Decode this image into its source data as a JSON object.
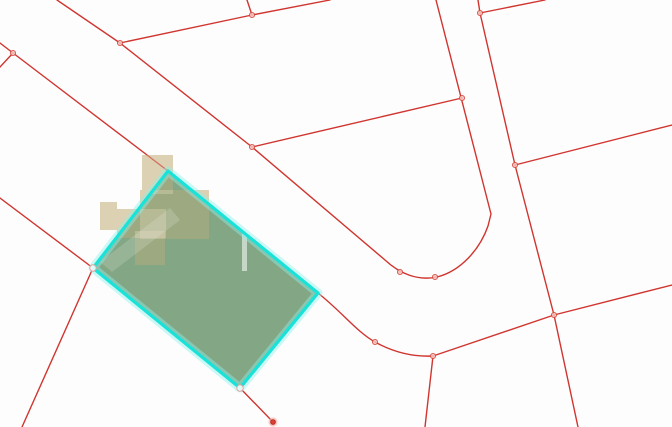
{
  "map": {
    "description": "cadastral-parcel-map-with-selected-parcel",
    "canvas": {
      "width": 672,
      "height": 427,
      "background": "#fdfdfd"
    },
    "colors": {
      "boundary_line": "#ce2a24",
      "vertex_fill": "#f6c0ba",
      "vertex_stroke": "#d4453c",
      "endpoint_fill": "#d94036",
      "endpoint_ring": "#f2b4ae",
      "selection_stroke": "#19e2d8",
      "selection_glow": "#8ef0e9",
      "parcel_fill": "rgba(10,80,12,0.5)",
      "building_fill": "#ddd1b3",
      "building_overlay": "rgba(221,209,179,0.4)",
      "driveway_fill": "rgba(255,255,255,0.55)",
      "path_band_fill": "rgba(255,255,255,0.16)"
    },
    "boundary_paths": [
      {
        "name": "road-northeast-edge-with-corner-fillet",
        "d": "M 57,0 L 120,43 L 252,147 L 385,260 C 400,274 418,281 437,277 C 461,271 480,249 488,226 L 491,214 L 436,0"
      },
      {
        "name": "north-parcel-split-line",
        "d": "M 120,43 L 252,15 L 330,0"
      },
      {
        "name": "north-parcel-stub",
        "d": "M 252,15 L 247,0"
      },
      {
        "name": "west-edge-junction",
        "d": "M 0,43 L 13,53 L 0,67"
      },
      {
        "name": "road-southwest-edge-through-parcel",
        "d": "M 13,53 L 168,171 L 318,293 C 343,313 357,332 375,342 C 393,352 413,357 433,356 L 554,315"
      },
      {
        "name": "south-branch-line",
        "d": "M 433,356 L 425,427"
      },
      {
        "name": "vertical-road-east-edge",
        "d": "M 478,0 L 480,13 L 515,165 L 554,315 L 578,427"
      },
      {
        "name": "northeast-corner-branch",
        "d": "M 480,13 L 545,0"
      },
      {
        "name": "east-parcel-line-upper",
        "d": "M 515,165 L 672,125"
      },
      {
        "name": "east-parcel-line-lower",
        "d": "M 554,315 L 672,285"
      },
      {
        "name": "mid-cross-boundary-line",
        "d": "M 252,147 L 462,98"
      },
      {
        "name": "west-parcel-boundary",
        "d": "M 0,198 L 93,268 L 22,427"
      },
      {
        "name": "selected-parcel-south-stub",
        "d": "M 240,388 L 273,422"
      }
    ],
    "vertices": [
      [
        13,
        53
      ],
      [
        120,
        43
      ],
      [
        252,
        15
      ],
      [
        252,
        147
      ],
      [
        462,
        98
      ],
      [
        480,
        13
      ],
      [
        515,
        165
      ],
      [
        554,
        315
      ],
      [
        375,
        342
      ],
      [
        400,
        272
      ],
      [
        435,
        277
      ],
      [
        433,
        356
      ]
    ],
    "corner_markers": [
      [
        93,
        268
      ],
      [
        240,
        388
      ]
    ],
    "endpoint_marker": [
      273,
      422
    ],
    "buildings": [
      [
        142,
        155,
        31,
        39
      ],
      [
        100,
        202,
        17,
        28
      ],
      [
        117,
        209,
        49,
        29
      ],
      [
        140,
        190,
        69,
        49
      ],
      [
        135,
        231,
        30,
        34
      ]
    ],
    "selected_parcel": {
      "points": "168,171 318,293 240,388 93,268"
    },
    "driveway": {
      "x": 242,
      "y": 228,
      "w": 5,
      "h": 43
    },
    "path_band": {
      "points": "100,262 170,208 180,220 112,272"
    }
  }
}
